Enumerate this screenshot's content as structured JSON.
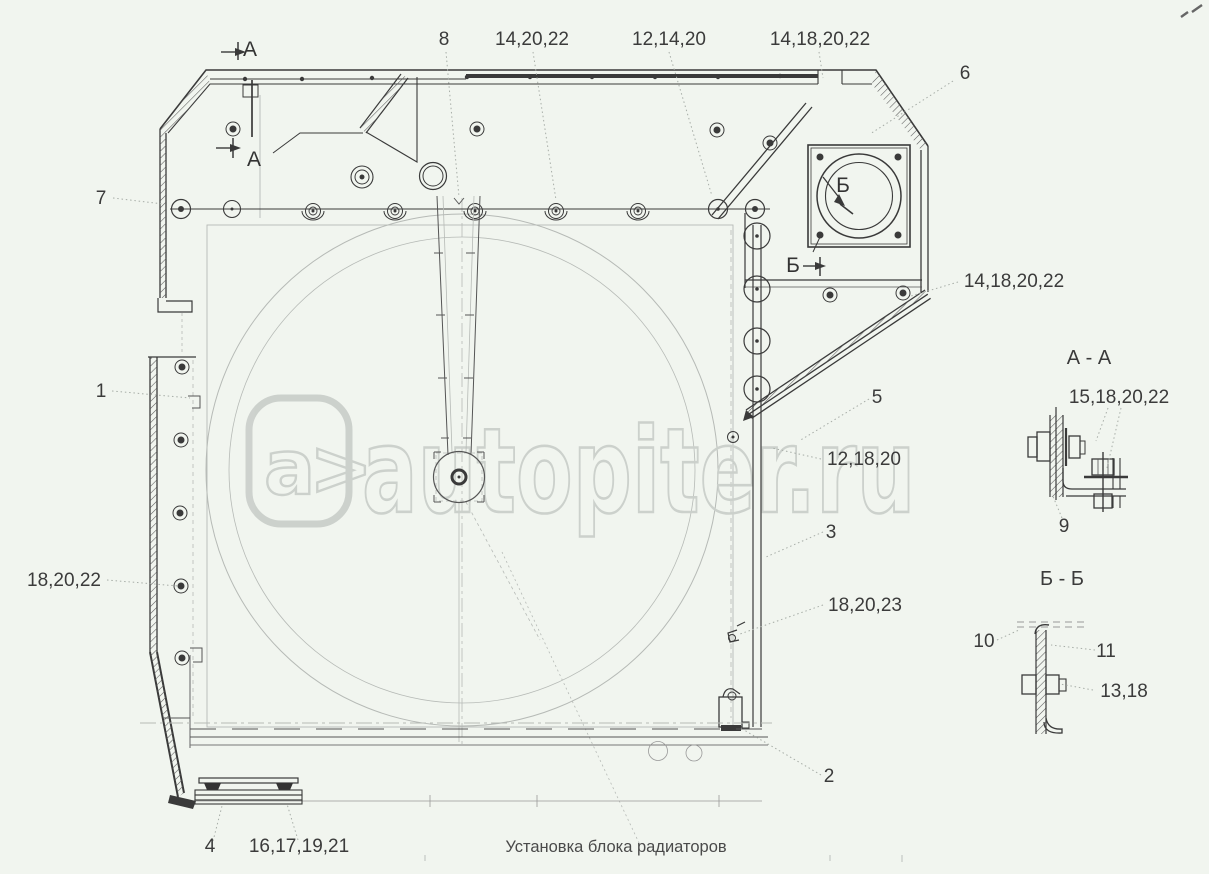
{
  "watermark": {
    "logo_text": "a>",
    "site": "autopiter.ru"
  },
  "caption": "Установка блока радиаторов",
  "section_markers": {
    "a": "А",
    "b": "Б"
  },
  "sections": {
    "aa": {
      "title": "А - А",
      "callout_15_18_20_22": "15,18,20,22",
      "callout_9": "9"
    },
    "bb": {
      "title": "Б - Б",
      "callout_10": "10",
      "callout_11": "11",
      "callout_13_18": "13,18"
    }
  },
  "callouts": {
    "c7": "7",
    "c8": "8",
    "c14_20_22": "14,20,22",
    "c12_14_20": "12,14,20",
    "c14_18_20_22_top": "14,18,20,22",
    "c6": "6",
    "c14_18_20_22_right": "14,18,20,22",
    "c1": "1",
    "c5": "5",
    "c12_18_20": "12,18,20",
    "c3": "3",
    "c18_20_22": "18,20,22",
    "c18_20_23": "18,20,23",
    "c2": "2",
    "c4": "4",
    "c16_17_19_21": "16,17,19,21"
  }
}
